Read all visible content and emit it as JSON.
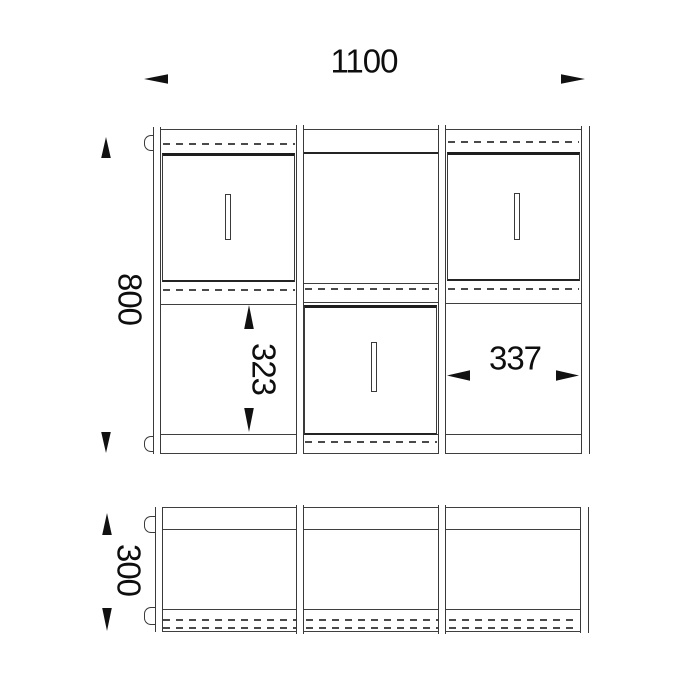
{
  "drawing": {
    "title": "cabinet technical drawing - front elevation and plan view",
    "front_view": {
      "overall_width_mm": "1100",
      "overall_height_mm": "800",
      "compartment_inner_height_mm": "323",
      "compartment_inner_width_mm": "337"
    },
    "plan_view": {
      "depth_mm": "300"
    },
    "colors": {
      "background": "#ffffff",
      "line": "#3f3f3f",
      "line_dark": "#1e1e1e",
      "text": "#0e0e0e"
    }
  }
}
